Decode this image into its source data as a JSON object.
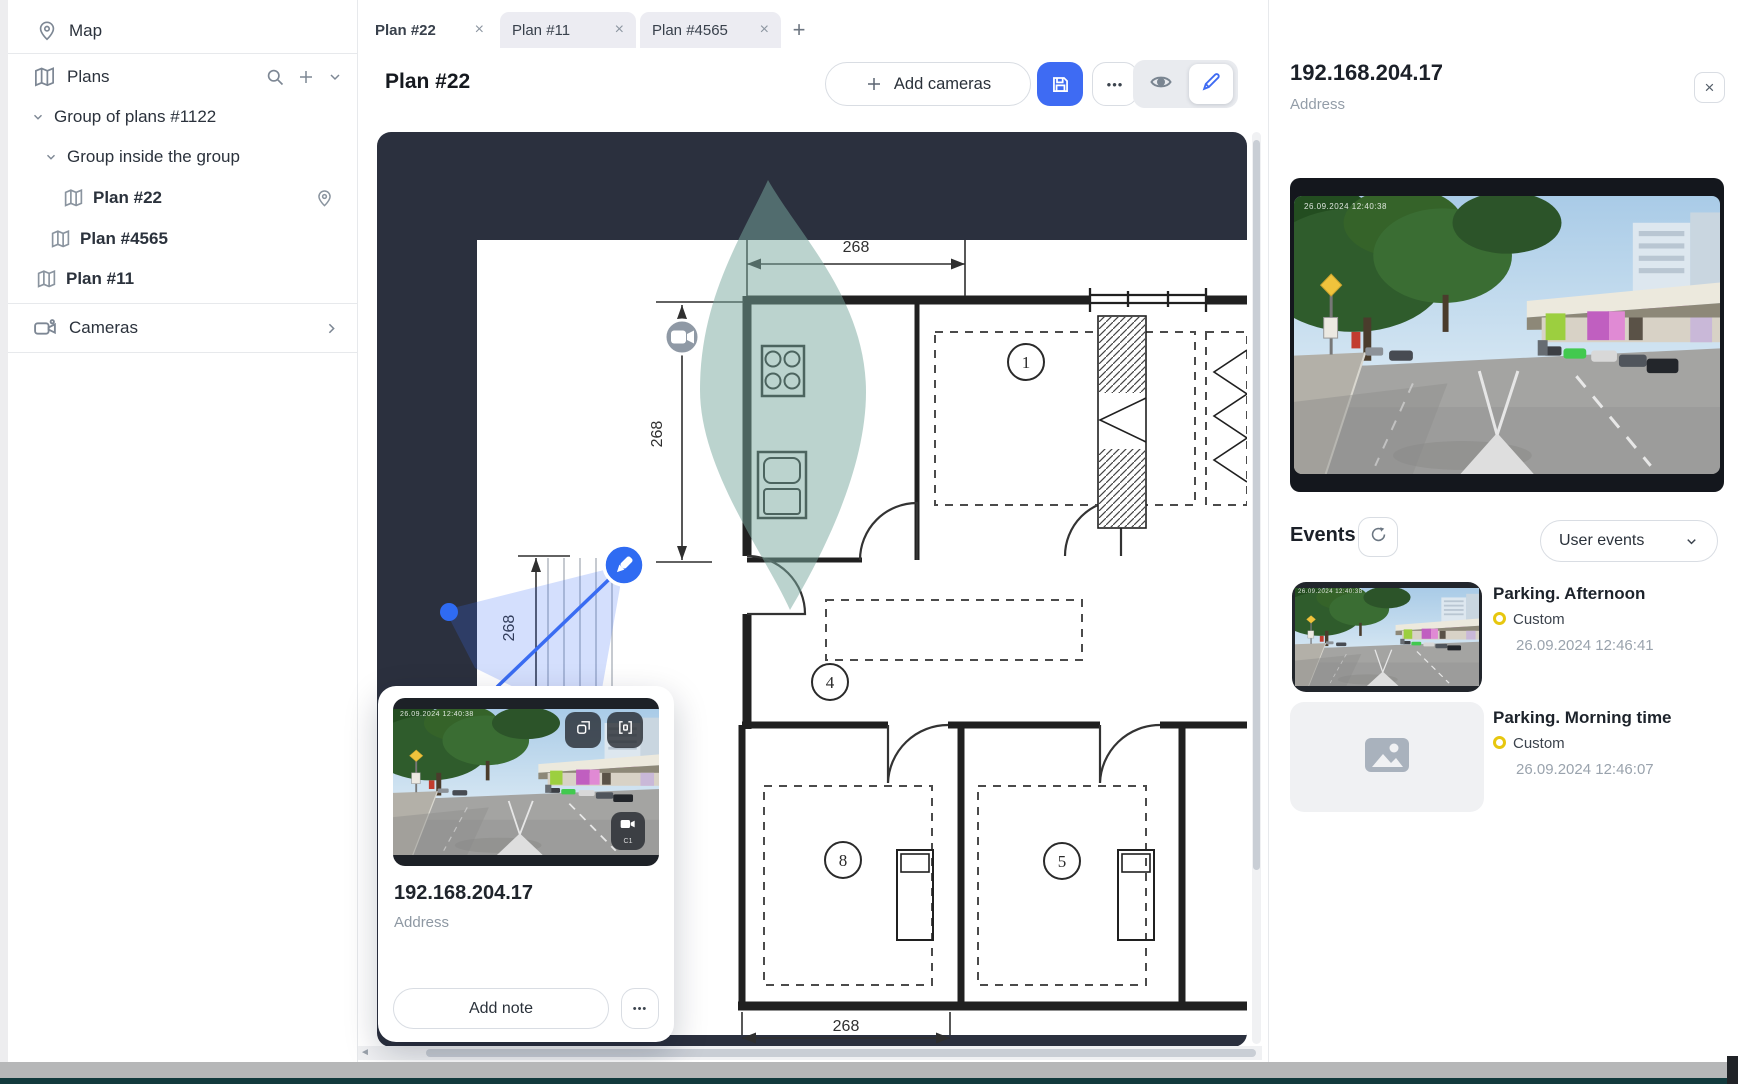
{
  "sidebar": {
    "map": {
      "label": "Map"
    },
    "plans": {
      "label": "Plans"
    },
    "cameras": {
      "label": "Cameras"
    },
    "tree": {
      "group1": "Group of plans #1122",
      "group2": "Group inside the group",
      "plan22": "Plan #22",
      "plan4565": "Plan #4565",
      "plan11": "Plan #11"
    }
  },
  "tabs": {
    "items": [
      {
        "label": "Plan #22",
        "active": true
      },
      {
        "label": "Plan #11",
        "active": false
      },
      {
        "label": "Plan #4565",
        "active": false
      }
    ],
    "close_glyph": "×",
    "add_glyph": "+"
  },
  "toolbar": {
    "title": "Plan #22",
    "add_cameras_label": "Add cameras",
    "add_glyph": "+",
    "more_glyph": "•••"
  },
  "plan": {
    "dim_top": "268",
    "dim_left": "268",
    "dim_inner": "268",
    "dim_bottom": "268",
    "room_numbers": {
      "r1": "1",
      "r4": "4",
      "r8": "8",
      "r5": "5"
    },
    "background": "#2b303e"
  },
  "popup": {
    "ip": "192.168.204.17",
    "address_label": "Address",
    "add_note_label": "Add note",
    "more_glyph": "•••",
    "osd_timestamp": "26.09.2024 12:40:38",
    "camera_badge": "C1"
  },
  "panel": {
    "ip": "192.168.204.17",
    "address_label": "Address",
    "close_glyph": "×",
    "osd_timestamp": "26.09.2024 12:40:38",
    "events": {
      "title": "Events",
      "filter_label": "User events",
      "items": [
        {
          "title": "Parking. Afternoon",
          "type": "Custom",
          "time": "26.09.2024 12:46:41"
        },
        {
          "title": "Parking. Morning time",
          "type": "Custom",
          "time": "26.09.2024 12:46:07"
        }
      ]
    }
  }
}
